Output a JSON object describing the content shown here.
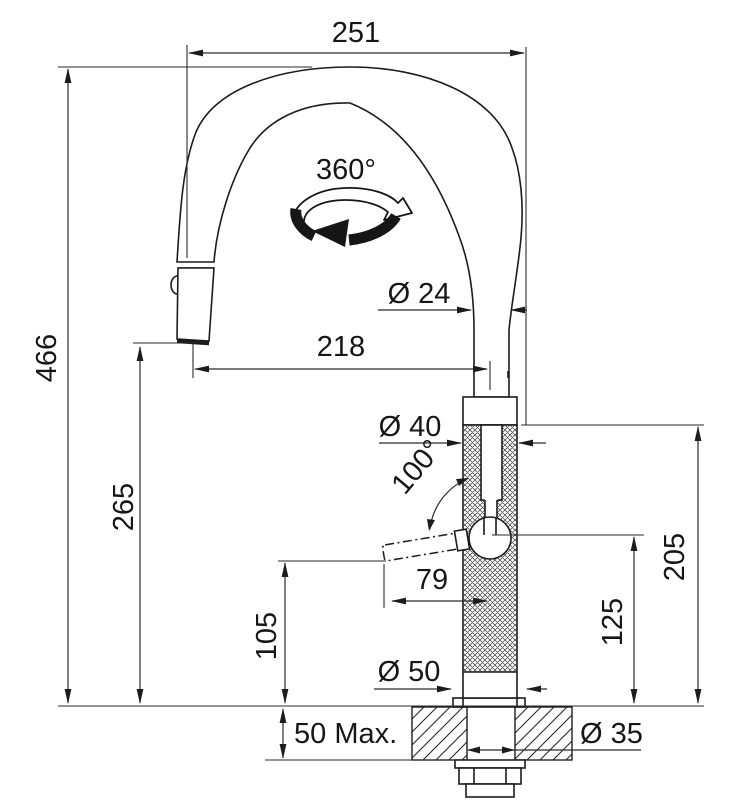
{
  "diagram": {
    "subject": "Kitchen pull-out mixer tap dimensioned installation drawing",
    "background_color": "#ffffff",
    "line_color": "#1c1c1c"
  },
  "labels": {
    "spout_width": "251",
    "swivel_angle": "360°",
    "spout_tube_diameter": "Ø 24",
    "spout_reach": "218",
    "overall_height": "466",
    "body_diameter": "Ø 40",
    "lever_angle": "100°",
    "outlet_height": "265",
    "lever_length": "79",
    "body_top_height": "205",
    "lever_pivot_height": "125",
    "lever_clearance_height": "105",
    "base_diameter": "Ø 50",
    "worktop_thickness": "50 Max.",
    "hole_diameter": "Ø 35"
  }
}
